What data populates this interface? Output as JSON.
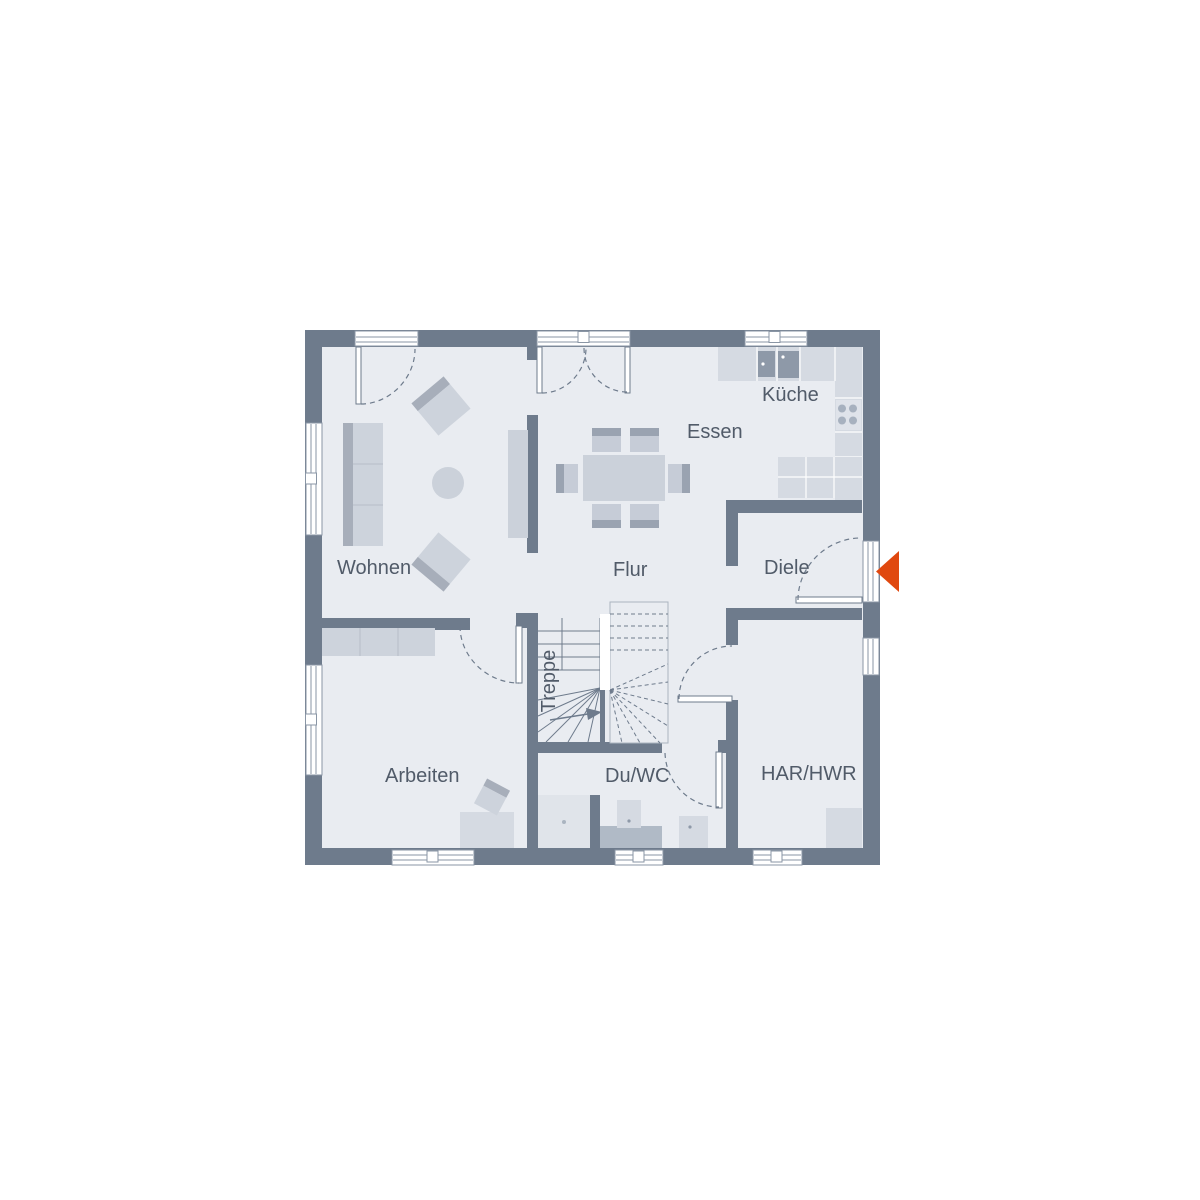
{
  "plan": {
    "labels": {
      "wohnen": "Wohnen",
      "essen": "Essen",
      "kueche": "Küche",
      "flur": "Flur",
      "diele": "Diele",
      "treppe": "Treppe",
      "arbeiten": "Arbeiten",
      "duwc": "Du/WC",
      "harhwr": "HAR/HWR"
    },
    "colors": {
      "wall": "#6e7b8c",
      "floor": "#e9ecf1",
      "furniture_light": "#cdd3dc",
      "furniture_dark": "#a7aeba",
      "counter": "#d5dae2",
      "appliance": "#8e99a8",
      "window_line": "#8a96a5",
      "text": "#515b69",
      "entrance_arrow": "#e0480f"
    }
  }
}
